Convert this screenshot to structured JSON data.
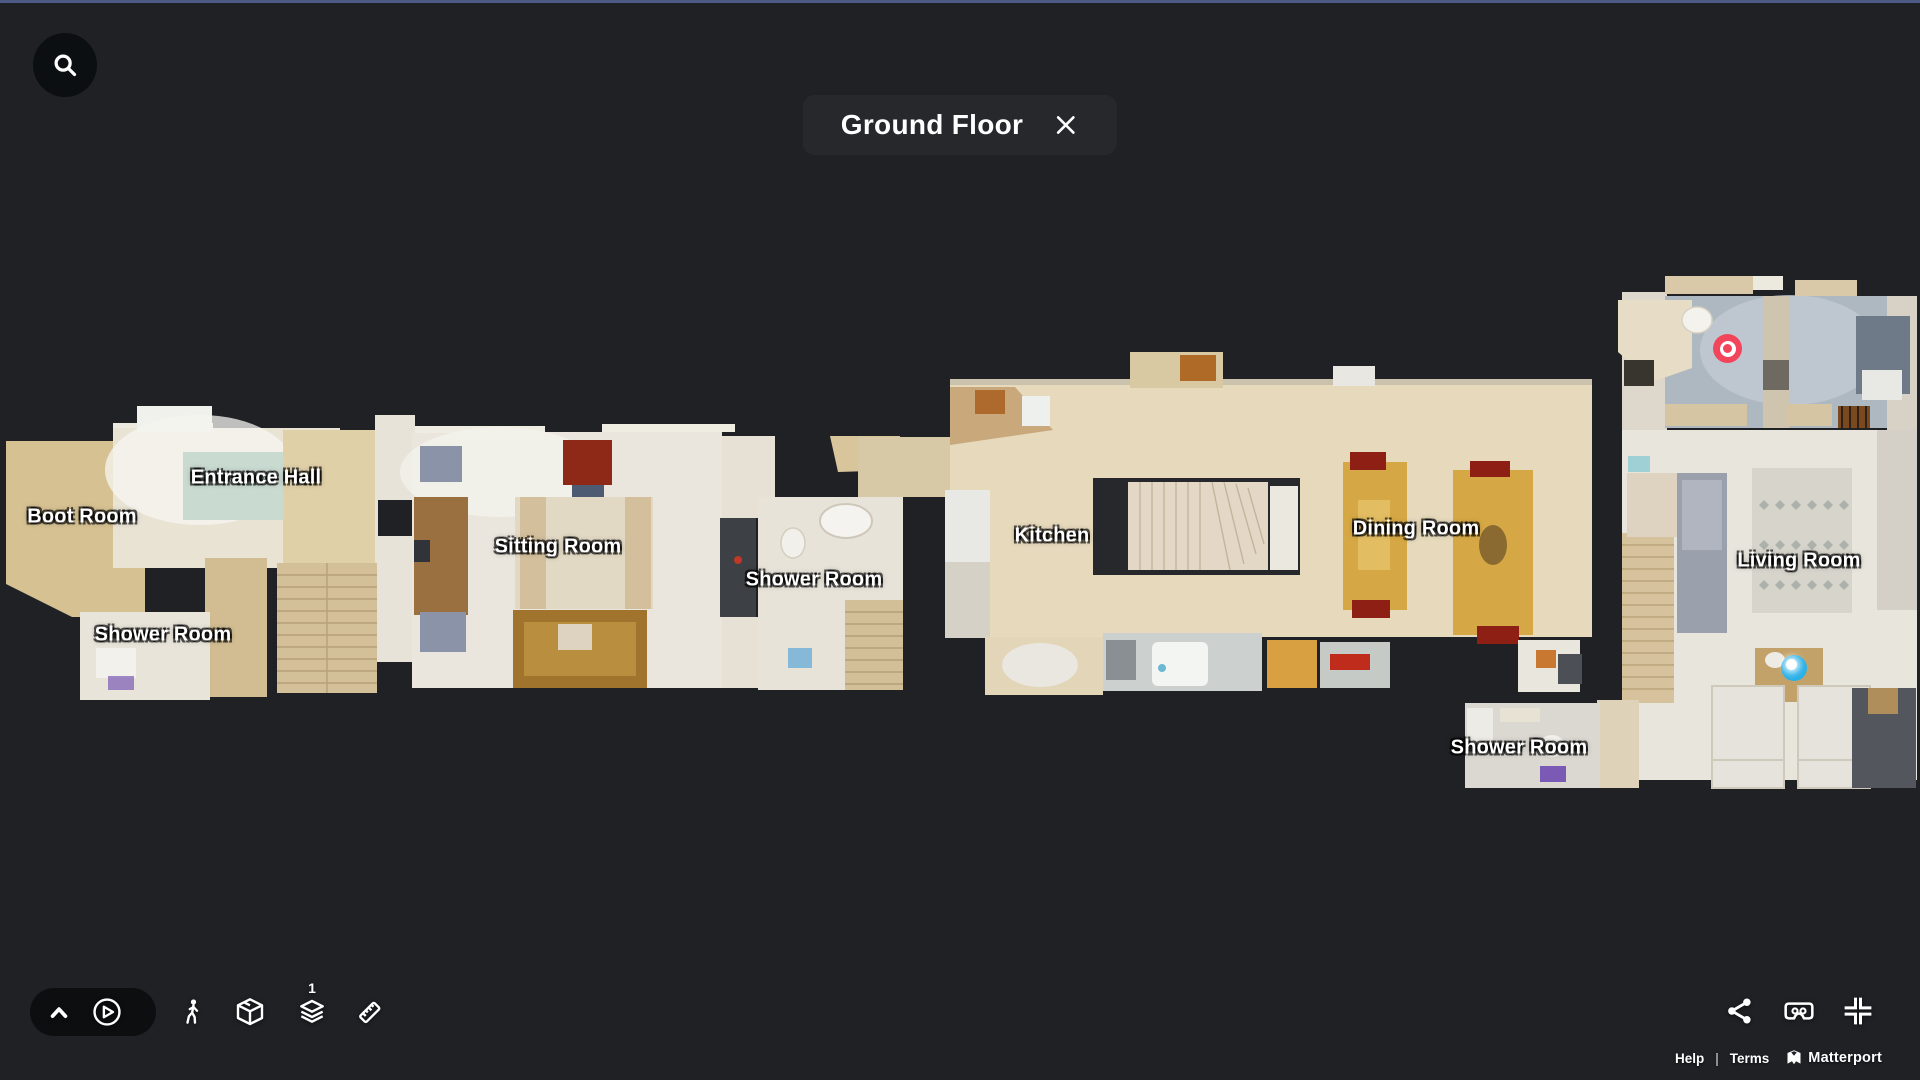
{
  "header": {
    "title": "Ground Floor"
  },
  "rooms": [
    {
      "name": "Boot Room"
    },
    {
      "name": "Entrance Hall"
    },
    {
      "name": "Shower Room"
    },
    {
      "name": "Sitting Room"
    },
    {
      "name": "Shower Room"
    },
    {
      "name": "Kitchen"
    },
    {
      "name": "Dining Room"
    },
    {
      "name": "Shower Room"
    },
    {
      "name": "Living Room"
    }
  ],
  "markers": [
    {
      "name": "tour-start-marker",
      "color": "#f2455c"
    },
    {
      "name": "current-position-marker",
      "color": "#29b0e8"
    }
  ],
  "toolbar": {
    "floor_badge": "1",
    "icons": [
      "search",
      "chevron-up",
      "play",
      "walk",
      "dollhouse",
      "floors",
      "measure"
    ]
  },
  "actions": {
    "icons": [
      "share",
      "vr-headset",
      "exit-fullscreen"
    ]
  },
  "footer": {
    "help": "Help",
    "separator": "|",
    "terms": "Terms",
    "brand": "Matterport"
  },
  "colors": {
    "background": "#1f2125",
    "top_accent": "#4e5a86",
    "marker_red": "#f2455c",
    "marker_blue": "#29b0e8",
    "floor_beige": "#e6d9bc",
    "floor_white": "#e9e4d8",
    "label_text": "#ffffff"
  }
}
